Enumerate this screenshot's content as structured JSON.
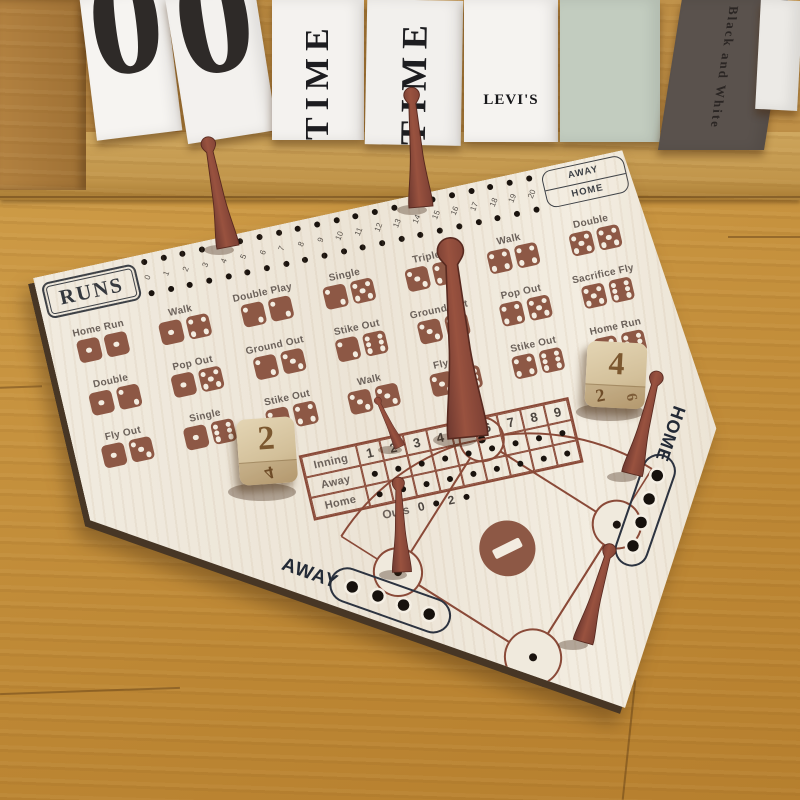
{
  "background": {
    "cards": [
      "0",
      "0"
    ],
    "books": [
      {
        "title": "TIME"
      },
      {
        "title": "TIME"
      },
      {
        "title": "LEVI'S"
      },
      {
        "title": ""
      },
      {
        "title": "Black and White"
      }
    ]
  },
  "board": {
    "runs_label": "RUNS",
    "runs_numbers": [
      "0",
      "1",
      "2",
      "3",
      "4",
      "5",
      "6",
      "7",
      "8",
      "9",
      "10",
      "11",
      "12",
      "13",
      "14",
      "15",
      "16",
      "17",
      "18",
      "19",
      "20"
    ],
    "track_end": {
      "away": "AWAY",
      "home": "HOME"
    },
    "combos": [
      {
        "label": "Home Run",
        "d1": 1,
        "d2": 1
      },
      {
        "label": "Double",
        "d1": 1,
        "d2": 2
      },
      {
        "label": "Fly Out",
        "d1": 1,
        "d2": 3
      },
      {
        "label": "Walk",
        "d1": 1,
        "d2": 4
      },
      {
        "label": "Pop Out",
        "d1": 1,
        "d2": 5
      },
      {
        "label": "Single",
        "d1": 1,
        "d2": 6
      },
      {
        "label": "Double Play",
        "d1": 2,
        "d2": 2
      },
      {
        "label": "Ground Out",
        "d1": 2,
        "d2": 3
      },
      {
        "label": "Stike Out",
        "d1": 2,
        "d2": 4
      },
      {
        "label": "Single",
        "d1": 2,
        "d2": 5
      },
      {
        "label": "Stike Out",
        "d1": 2,
        "d2": 6
      },
      {
        "label": "Walk",
        "d1": 3,
        "d2": 3
      },
      {
        "label": "Triple",
        "d1": 3,
        "d2": 4
      },
      {
        "label": "Ground Out",
        "d1": 3,
        "d2": 5
      },
      {
        "label": "Fly Out",
        "d1": 3,
        "d2": 6
      },
      {
        "label": "Walk",
        "d1": 4,
        "d2": 4
      },
      {
        "label": "Pop Out",
        "d1": 4,
        "d2": 5
      },
      {
        "label": "Stike Out",
        "d1": 4,
        "d2": 6
      },
      {
        "label": "Double",
        "d1": 5,
        "d2": 5
      },
      {
        "label": "Sacrifice Fly",
        "d1": 5,
        "d2": 6
      },
      {
        "label": "Home Run",
        "d1": 6,
        "d2": 6
      }
    ],
    "scoreboard": {
      "row_labels": [
        "Inning",
        "Away",
        "Home"
      ],
      "innings": [
        "1",
        "2",
        "3",
        "4",
        "5",
        "6",
        "7",
        "8",
        "9"
      ],
      "outs_label": "Outs",
      "outs_values": [
        "0",
        "2"
      ]
    },
    "field": {
      "away_label": "AWAY",
      "home_label": "HOME"
    }
  },
  "pieces": {
    "pegs": [
      "runs-track-home-5",
      "runs-track-away-14",
      "outs-marker",
      "second-base",
      "third-base",
      "first-base",
      "home-plate"
    ],
    "die_left": {
      "top": "2",
      "front": "4"
    },
    "die_right": {
      "top": "4",
      "front": "2",
      "side": "6"
    }
  },
  "colors": {
    "board_cream": "#f0eadd",
    "print_brown": "#8d5845",
    "line_brown": "#8a4a38",
    "label_gray": "#6b615a",
    "peg_red": "#8e4b3b",
    "table_oak": "#c89440",
    "book_green": "#c2ccbf",
    "book_dark": "#5a524d"
  }
}
